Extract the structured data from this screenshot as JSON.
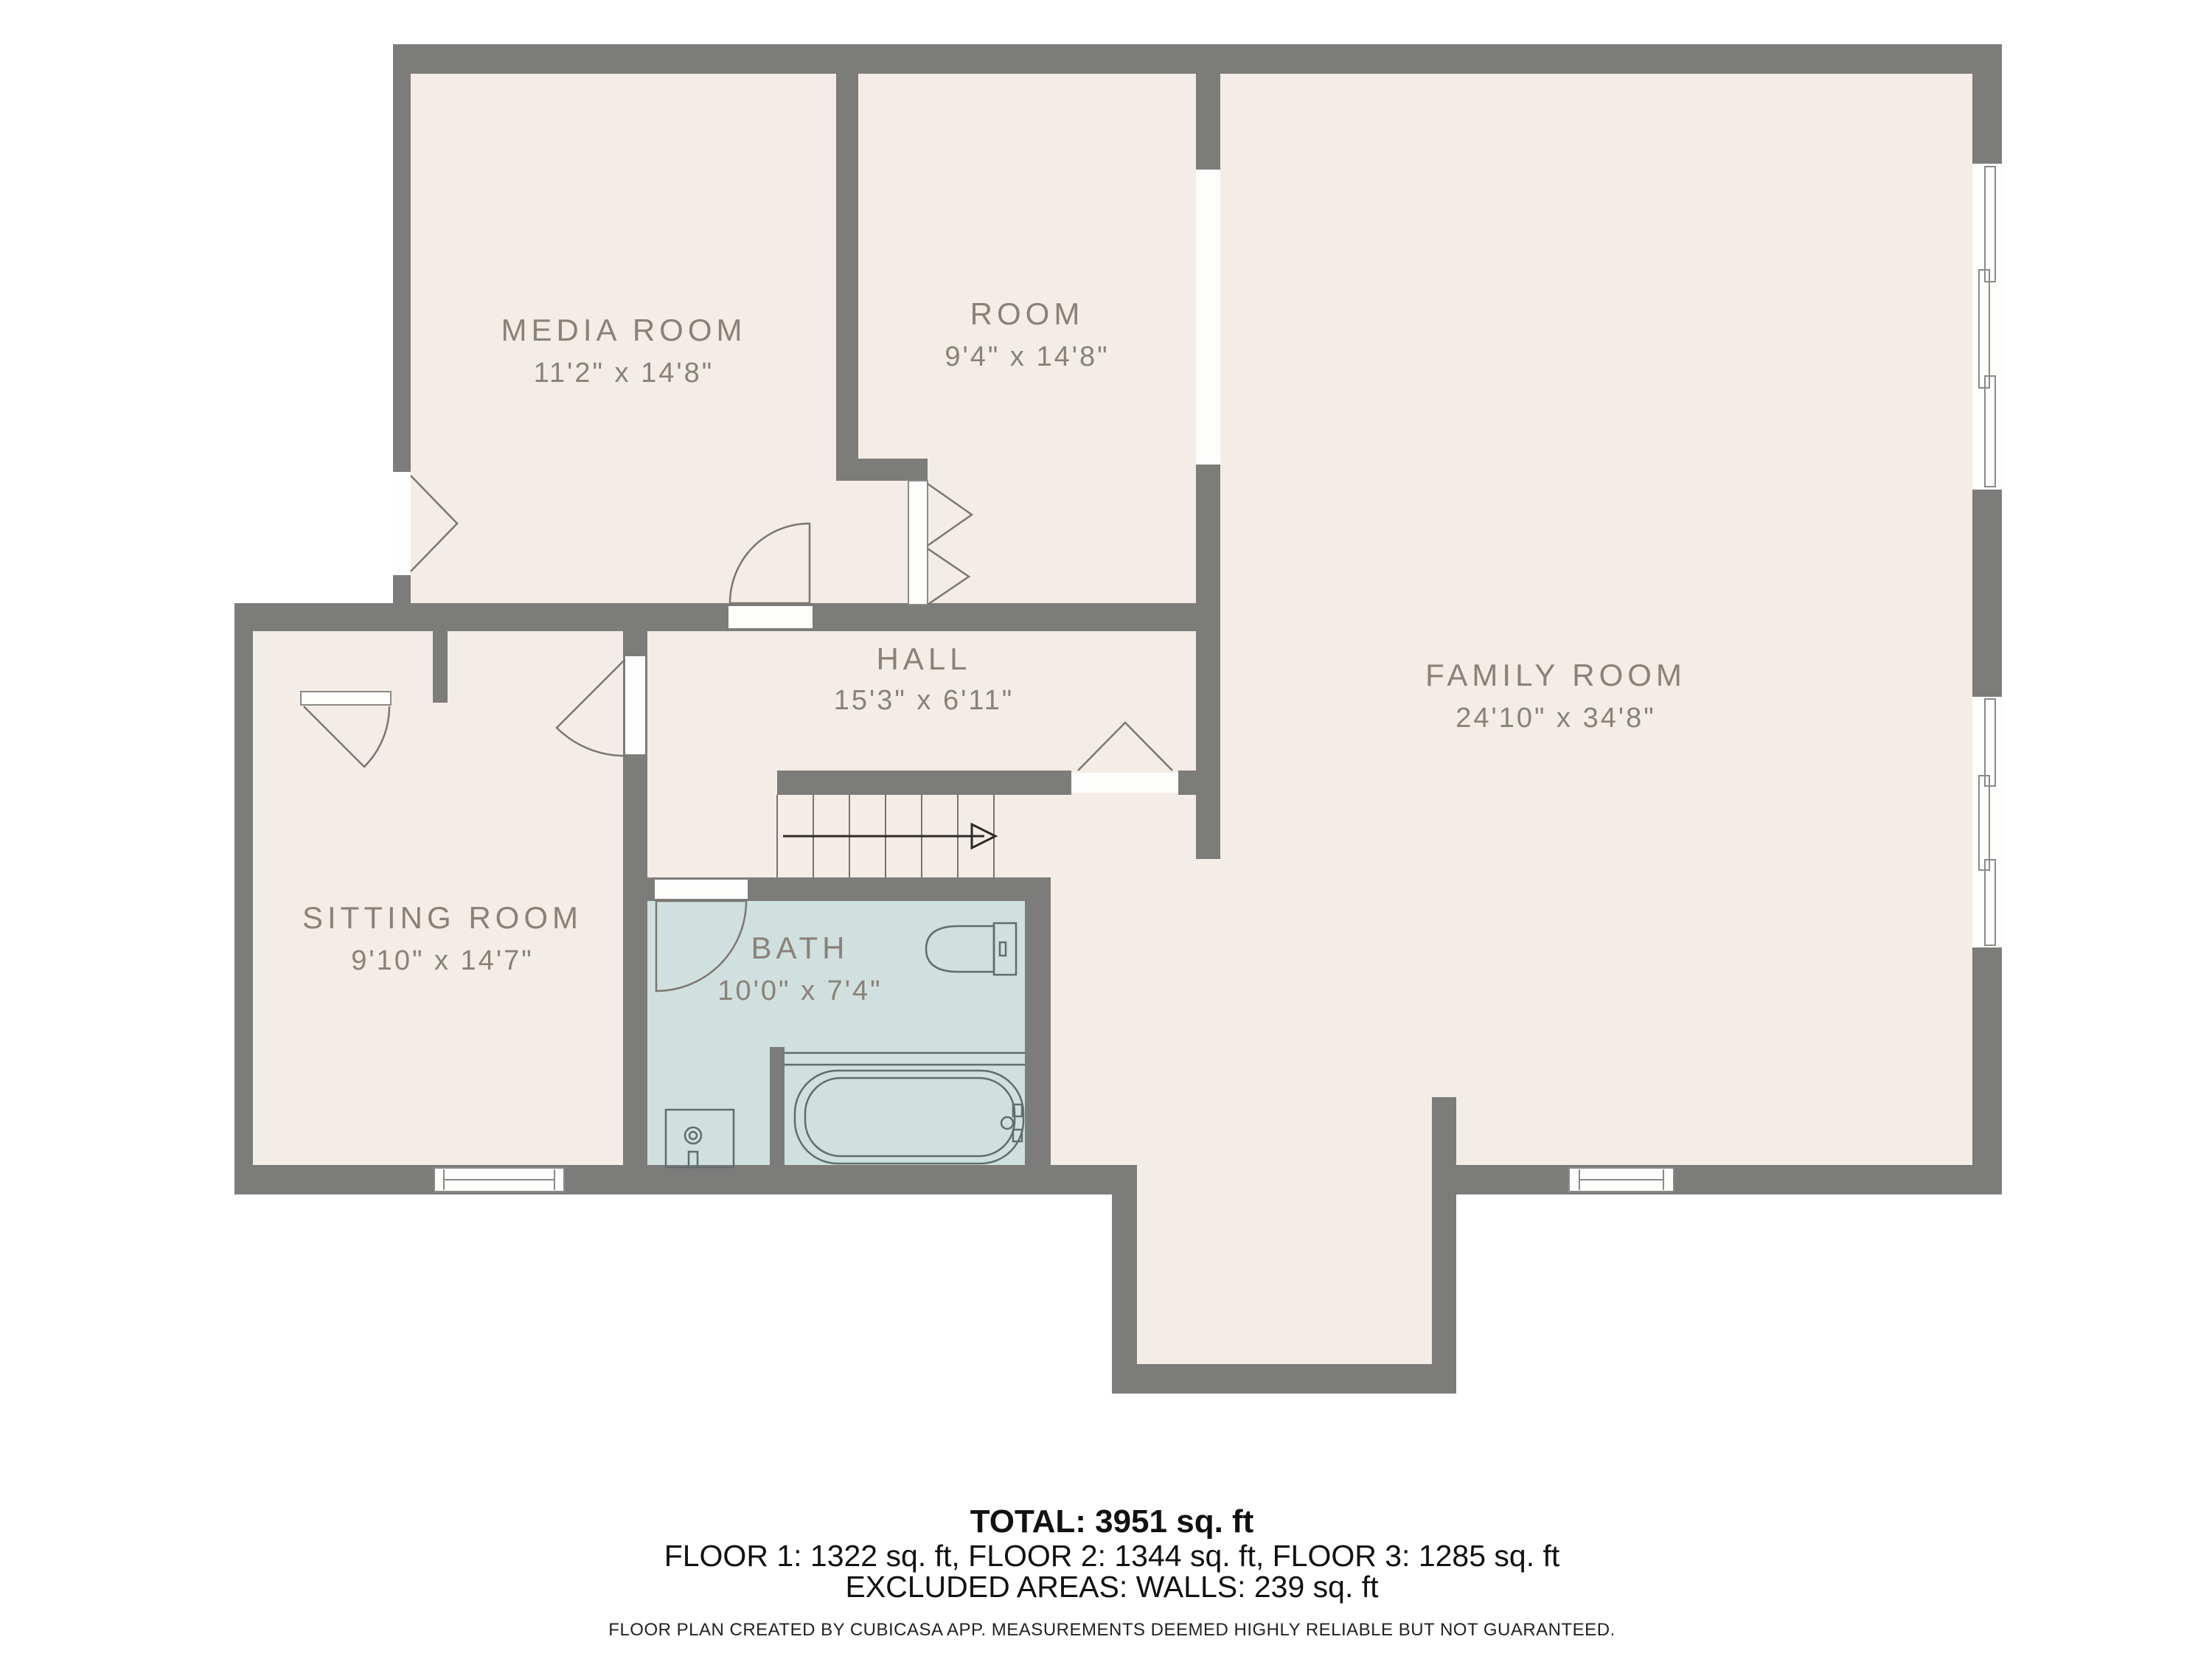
{
  "plan": {
    "type": "floor-plan",
    "creator_note": "FLOOR PLAN CREATED BY CUBICASA APP. MEASUREMENTS DEEMED HIGHLY RELIABLE BUT NOT GUARANTEED."
  },
  "palette": {
    "background": "#ffffff",
    "floor": "#f4ece6",
    "wall": "#7c7c7a",
    "bath_floor": "#cfe0df",
    "opening": "#fdfdfb",
    "label_text": "#8b8178",
    "footer_text": "#111111"
  },
  "rooms": [
    {
      "id": "media-room",
      "name": "MEDIA ROOM",
      "dims": "11'2\" x 14'8\""
    },
    {
      "id": "room",
      "name": "ROOM",
      "dims": "9'4\" x 14'8\""
    },
    {
      "id": "family-room",
      "name": "FAMILY ROOM",
      "dims": "24'10\" x 34'8\""
    },
    {
      "id": "hall",
      "name": "HALL",
      "dims": "15'3\" x 6'11\""
    },
    {
      "id": "sitting-room",
      "name": "SITTING ROOM",
      "dims": "9'10\" x 14'7\""
    },
    {
      "id": "bath",
      "name": "BATH",
      "dims": "10'0\" x 7'4\""
    }
  ],
  "footer": {
    "total": "TOTAL: 3951 sq. ft",
    "floors": "FLOOR 1: 1322 sq. ft, FLOOR 2: 1344 sq. ft, FLOOR 3: 1285 sq. ft",
    "excluded": "EXCLUDED AREAS: WALLS: 239 sq. ft",
    "disclaimer": "FLOOR PLAN CREATED BY CUBICASA APP. MEASUREMENTS DEEMED HIGHLY RELIABLE BUT NOT GUARANTEED."
  }
}
